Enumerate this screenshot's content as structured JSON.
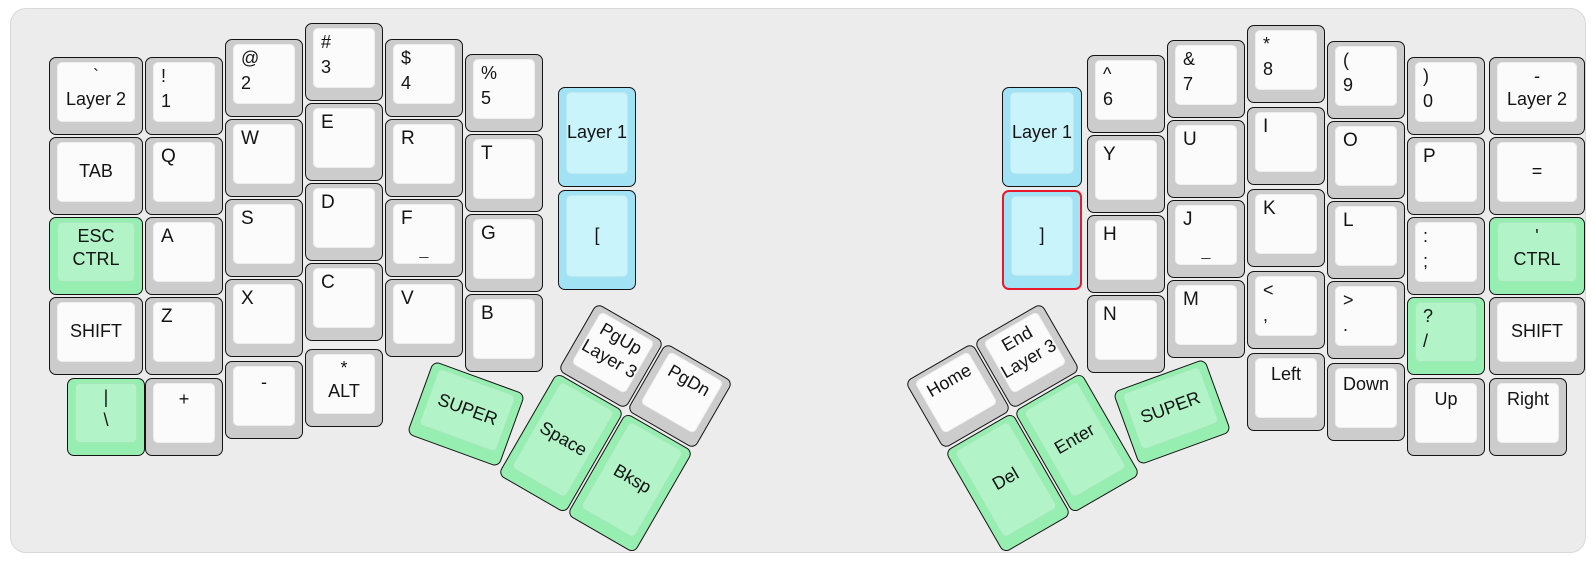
{
  "app": {
    "title": "Split ergonomic keyboard layout"
  },
  "colors": {
    "page_bg": "#ffffff",
    "board_bg": "#ececec",
    "board_border": "#d9d9d9",
    "key_border": "#141414",
    "white_bezel": "#cccccc",
    "white_top": "#fbfbfb",
    "green_bezel": "#96eeb0",
    "green_top": "#b2f4c7",
    "blue_bezel": "#a2e2f5",
    "blue_top": "#c9f4fc",
    "highlight_border": "#e8192c",
    "text": "#141414"
  },
  "keys": [
    {
      "id": "key-layer2-left",
      "x": 38,
      "y": 48,
      "w": 94,
      "h": 78,
      "rot": 0,
      "color": "white",
      "style": "center2",
      "labels": [
        "`",
        "Layer 2"
      ]
    },
    {
      "id": "key-tab",
      "x": 38,
      "y": 128,
      "w": 94,
      "h": 78,
      "rot": 0,
      "color": "white",
      "style": "center",
      "labels": [
        "TAB"
      ]
    },
    {
      "id": "key-esc-ctrl",
      "x": 38,
      "y": 208,
      "w": 94,
      "h": 78,
      "rot": 0,
      "color": "green",
      "style": "center2",
      "labels": [
        "ESC",
        "CTRL"
      ]
    },
    {
      "id": "key-shift-left",
      "x": 38,
      "y": 288,
      "w": 94,
      "h": 78,
      "rot": 0,
      "color": "white",
      "style": "center",
      "labels": [
        "SHIFT"
      ]
    },
    {
      "id": "key-pipe-backslash",
      "x": 56,
      "y": 369,
      "w": 78,
      "h": 78,
      "rot": 0,
      "color": "green",
      "style": "center2",
      "labels": [
        "|",
        "\\"
      ]
    },
    {
      "id": "key-1",
      "x": 134,
      "y": 48,
      "w": 78,
      "h": 78,
      "rot": 0,
      "color": "white",
      "style": "pair",
      "labels": [
        "!",
        "1"
      ]
    },
    {
      "id": "key-q",
      "x": 134,
      "y": 128,
      "w": 78,
      "h": 78,
      "rot": 0,
      "color": "white",
      "style": "tl",
      "labels": [
        "Q"
      ]
    },
    {
      "id": "key-a",
      "x": 134,
      "y": 208,
      "w": 78,
      "h": 78,
      "rot": 0,
      "color": "white",
      "style": "tl",
      "labels": [
        "A"
      ]
    },
    {
      "id": "key-z",
      "x": 134,
      "y": 288,
      "w": 78,
      "h": 78,
      "rot": 0,
      "color": "white",
      "style": "tl",
      "labels": [
        "Z"
      ]
    },
    {
      "id": "key-plus",
      "x": 134,
      "y": 369,
      "w": 78,
      "h": 78,
      "rot": 0,
      "color": "white",
      "style": "top",
      "labels": [
        "+"
      ]
    },
    {
      "id": "key-2",
      "x": 214,
      "y": 30,
      "w": 78,
      "h": 78,
      "rot": 0,
      "color": "white",
      "style": "pair",
      "labels": [
        "@",
        "2"
      ]
    },
    {
      "id": "key-w",
      "x": 214,
      "y": 110,
      "w": 78,
      "h": 78,
      "rot": 0,
      "color": "white",
      "style": "tl",
      "labels": [
        "W"
      ]
    },
    {
      "id": "key-s",
      "x": 214,
      "y": 190,
      "w": 78,
      "h": 78,
      "rot": 0,
      "color": "white",
      "style": "tl",
      "labels": [
        "S"
      ]
    },
    {
      "id": "key-x",
      "x": 214,
      "y": 270,
      "w": 78,
      "h": 78,
      "rot": 0,
      "color": "white",
      "style": "tl",
      "labels": [
        "X"
      ]
    },
    {
      "id": "key-minus-left",
      "x": 214,
      "y": 352,
      "w": 78,
      "h": 78,
      "rot": 0,
      "color": "white",
      "style": "top",
      "labels": [
        "-"
      ]
    },
    {
      "id": "key-3",
      "x": 294,
      "y": 14,
      "w": 78,
      "h": 78,
      "rot": 0,
      "color": "white",
      "style": "pair",
      "labels": [
        "#",
        "3"
      ]
    },
    {
      "id": "key-e",
      "x": 294,
      "y": 94,
      "w": 78,
      "h": 78,
      "rot": 0,
      "color": "white",
      "style": "tl",
      "labels": [
        "E"
      ]
    },
    {
      "id": "key-d",
      "x": 294,
      "y": 174,
      "w": 78,
      "h": 78,
      "rot": 0,
      "color": "white",
      "style": "tl",
      "labels": [
        "D"
      ]
    },
    {
      "id": "key-c",
      "x": 294,
      "y": 254,
      "w": 78,
      "h": 78,
      "rot": 0,
      "color": "white",
      "style": "tl",
      "labels": [
        "C"
      ]
    },
    {
      "id": "key-star-alt",
      "x": 294,
      "y": 340,
      "w": 78,
      "h": 78,
      "rot": 0,
      "color": "white",
      "style": "center2",
      "labels": [
        "*",
        "ALT"
      ]
    },
    {
      "id": "key-4",
      "x": 374,
      "y": 30,
      "w": 78,
      "h": 78,
      "rot": 0,
      "color": "white",
      "style": "pair",
      "labels": [
        "$",
        "4"
      ]
    },
    {
      "id": "key-r",
      "x": 374,
      "y": 110,
      "w": 78,
      "h": 78,
      "rot": 0,
      "color": "white",
      "style": "tl",
      "labels": [
        "R"
      ]
    },
    {
      "id": "key-f",
      "x": 374,
      "y": 190,
      "w": 78,
      "h": 78,
      "rot": 0,
      "color": "white",
      "style": "homing",
      "labels": [
        "F",
        "_"
      ]
    },
    {
      "id": "key-v",
      "x": 374,
      "y": 270,
      "w": 78,
      "h": 78,
      "rot": 0,
      "color": "white",
      "style": "tl",
      "labels": [
        "V"
      ]
    },
    {
      "id": "key-5",
      "x": 454,
      "y": 45,
      "w": 78,
      "h": 78,
      "rot": 0,
      "color": "white",
      "style": "pair",
      "labels": [
        "%",
        "5"
      ]
    },
    {
      "id": "key-t",
      "x": 454,
      "y": 125,
      "w": 78,
      "h": 78,
      "rot": 0,
      "color": "white",
      "style": "tl",
      "labels": [
        "T"
      ]
    },
    {
      "id": "key-g",
      "x": 454,
      "y": 205,
      "w": 78,
      "h": 78,
      "rot": 0,
      "color": "white",
      "style": "tl",
      "labels": [
        "G"
      ]
    },
    {
      "id": "key-b",
      "x": 454,
      "y": 285,
      "w": 78,
      "h": 78,
      "rot": 0,
      "color": "white",
      "style": "tl",
      "labels": [
        "B"
      ]
    },
    {
      "id": "key-layer1-left",
      "x": 547,
      "y": 78,
      "w": 78,
      "h": 100,
      "rot": 0,
      "color": "blue",
      "style": "center",
      "labels": [
        "Layer 1"
      ]
    },
    {
      "id": "key-lbracket",
      "x": 547,
      "y": 181,
      "w": 78,
      "h": 100,
      "rot": 0,
      "color": "blue",
      "style": "center",
      "labels": [
        "["
      ]
    },
    {
      "id": "key-pgup-layer3",
      "x": 561,
      "y": 308,
      "w": 78,
      "h": 78,
      "rot": 30,
      "color": "white",
      "style": "center2",
      "labels": [
        "PgUp",
        "Layer 3"
      ]
    },
    {
      "id": "key-pgdn",
      "x": 630,
      "y": 348,
      "w": 78,
      "h": 78,
      "rot": 30,
      "color": "white",
      "style": "top",
      "labels": [
        "PgDn"
      ]
    },
    {
      "id": "key-super-left",
      "x": 406,
      "y": 366,
      "w": 98,
      "h": 78,
      "rot": 20,
      "color": "green",
      "style": "center",
      "labels": [
        "SUPER"
      ]
    },
    {
      "id": "key-space",
      "x": 511,
      "y": 375,
      "w": 78,
      "h": 118,
      "rot": 30,
      "color": "green",
      "style": "center",
      "labels": [
        "Space"
      ]
    },
    {
      "id": "key-bksp",
      "x": 580,
      "y": 415,
      "w": 78,
      "h": 118,
      "rot": 30,
      "color": "green",
      "style": "center",
      "labels": [
        "Bksp"
      ]
    },
    {
      "id": "key-layer1-right",
      "x": 991,
      "y": 78,
      "w": 80,
      "h": 100,
      "rot": 0,
      "color": "blue",
      "style": "center",
      "labels": [
        "Layer 1"
      ]
    },
    {
      "id": "key-rbracket",
      "x": 991,
      "y": 181,
      "w": 80,
      "h": 100,
      "rot": 0,
      "color": "blue",
      "style": "center",
      "labels": [
        "]"
      ],
      "highlight": true
    },
    {
      "id": "key-6",
      "x": 1076,
      "y": 46,
      "w": 78,
      "h": 78,
      "rot": 0,
      "color": "white",
      "style": "pair",
      "labels": [
        "^",
        "6"
      ]
    },
    {
      "id": "key-y",
      "x": 1076,
      "y": 126,
      "w": 78,
      "h": 78,
      "rot": 0,
      "color": "white",
      "style": "tl",
      "labels": [
        "Y"
      ]
    },
    {
      "id": "key-h",
      "x": 1076,
      "y": 206,
      "w": 78,
      "h": 78,
      "rot": 0,
      "color": "white",
      "style": "tl",
      "labels": [
        "H"
      ]
    },
    {
      "id": "key-n",
      "x": 1076,
      "y": 286,
      "w": 78,
      "h": 78,
      "rot": 0,
      "color": "white",
      "style": "tl",
      "labels": [
        "N"
      ]
    },
    {
      "id": "key-7",
      "x": 1156,
      "y": 31,
      "w": 78,
      "h": 78,
      "rot": 0,
      "color": "white",
      "style": "pair",
      "labels": [
        "&",
        "7"
      ]
    },
    {
      "id": "key-u",
      "x": 1156,
      "y": 111,
      "w": 78,
      "h": 78,
      "rot": 0,
      "color": "white",
      "style": "tl",
      "labels": [
        "U"
      ]
    },
    {
      "id": "key-j",
      "x": 1156,
      "y": 191,
      "w": 78,
      "h": 78,
      "rot": 0,
      "color": "white",
      "style": "homing",
      "labels": [
        "J",
        "_"
      ]
    },
    {
      "id": "key-m",
      "x": 1156,
      "y": 271,
      "w": 78,
      "h": 78,
      "rot": 0,
      "color": "white",
      "style": "tl",
      "labels": [
        "M"
      ]
    },
    {
      "id": "key-8",
      "x": 1236,
      "y": 16,
      "w": 78,
      "h": 78,
      "rot": 0,
      "color": "white",
      "style": "pair",
      "labels": [
        "*",
        "8"
      ]
    },
    {
      "id": "key-i",
      "x": 1236,
      "y": 98,
      "w": 78,
      "h": 78,
      "rot": 0,
      "color": "white",
      "style": "tl",
      "labels": [
        "I"
      ]
    },
    {
      "id": "key-k",
      "x": 1236,
      "y": 180,
      "w": 78,
      "h": 78,
      "rot": 0,
      "color": "white",
      "style": "tl",
      "labels": [
        "K"
      ]
    },
    {
      "id": "key-comma",
      "x": 1236,
      "y": 262,
      "w": 78,
      "h": 78,
      "rot": 0,
      "color": "white",
      "style": "pair",
      "labels": [
        "<",
        ","
      ]
    },
    {
      "id": "key-left",
      "x": 1236,
      "y": 344,
      "w": 78,
      "h": 78,
      "rot": 0,
      "color": "white",
      "style": "top",
      "labels": [
        "Left"
      ]
    },
    {
      "id": "key-9",
      "x": 1316,
      "y": 32,
      "w": 78,
      "h": 78,
      "rot": 0,
      "color": "white",
      "style": "pair",
      "labels": [
        "(",
        "9"
      ]
    },
    {
      "id": "key-o",
      "x": 1316,
      "y": 112,
      "w": 78,
      "h": 78,
      "rot": 0,
      "color": "white",
      "style": "tl",
      "labels": [
        "O"
      ]
    },
    {
      "id": "key-l",
      "x": 1316,
      "y": 192,
      "w": 78,
      "h": 78,
      "rot": 0,
      "color": "white",
      "style": "tl",
      "labels": [
        "L"
      ]
    },
    {
      "id": "key-period",
      "x": 1316,
      "y": 272,
      "w": 78,
      "h": 78,
      "rot": 0,
      "color": "white",
      "style": "pair",
      "labels": [
        ">",
        "."
      ]
    },
    {
      "id": "key-down",
      "x": 1316,
      "y": 354,
      "w": 78,
      "h": 78,
      "rot": 0,
      "color": "white",
      "style": "top",
      "labels": [
        "Down"
      ]
    },
    {
      "id": "key-0",
      "x": 1396,
      "y": 48,
      "w": 78,
      "h": 78,
      "rot": 0,
      "color": "white",
      "style": "pair",
      "labels": [
        ")",
        "0"
      ]
    },
    {
      "id": "key-p",
      "x": 1396,
      "y": 128,
      "w": 78,
      "h": 78,
      "rot": 0,
      "color": "white",
      "style": "tl",
      "labels": [
        "P"
      ]
    },
    {
      "id": "key-semicolon",
      "x": 1396,
      "y": 208,
      "w": 78,
      "h": 78,
      "rot": 0,
      "color": "white",
      "style": "pair",
      "labels": [
        ":",
        ";"
      ]
    },
    {
      "id": "key-slash",
      "x": 1396,
      "y": 288,
      "w": 78,
      "h": 78,
      "rot": 0,
      "color": "green",
      "style": "pair",
      "labels": [
        "?",
        "/"
      ]
    },
    {
      "id": "key-up",
      "x": 1396,
      "y": 369,
      "w": 78,
      "h": 78,
      "rot": 0,
      "color": "white",
      "style": "top",
      "labels": [
        "Up"
      ]
    },
    {
      "id": "key-layer2-right",
      "x": 1478,
      "y": 48,
      "w": 96,
      "h": 78,
      "rot": 0,
      "color": "white",
      "style": "center2",
      "labels": [
        "-",
        "Layer 2"
      ]
    },
    {
      "id": "key-equals",
      "x": 1478,
      "y": 128,
      "w": 96,
      "h": 78,
      "rot": 0,
      "color": "white",
      "style": "center",
      "labels": [
        "="
      ]
    },
    {
      "id": "key-quote-ctrl",
      "x": 1478,
      "y": 208,
      "w": 96,
      "h": 78,
      "rot": 0,
      "color": "green",
      "style": "center2",
      "labels": [
        "'",
        "CTRL"
      ]
    },
    {
      "id": "key-shift-right",
      "x": 1478,
      "y": 288,
      "w": 96,
      "h": 78,
      "rot": 0,
      "color": "white",
      "style": "center",
      "labels": [
        "SHIFT"
      ]
    },
    {
      "id": "key-right",
      "x": 1478,
      "y": 369,
      "w": 78,
      "h": 78,
      "rot": 0,
      "color": "white",
      "style": "top",
      "labels": [
        "Right"
      ]
    },
    {
      "id": "key-home",
      "x": 908,
      "y": 348,
      "w": 78,
      "h": 78,
      "rot": -30,
      "color": "white",
      "style": "top",
      "labels": [
        "Home"
      ]
    },
    {
      "id": "key-end-layer3",
      "x": 977,
      "y": 308,
      "w": 78,
      "h": 78,
      "rot": -30,
      "color": "white",
      "style": "center2",
      "labels": [
        "End",
        "Layer 3"
      ]
    },
    {
      "id": "key-del",
      "x": 958,
      "y": 415,
      "w": 78,
      "h": 118,
      "rot": -30,
      "color": "green",
      "style": "center",
      "labels": [
        "Del"
      ]
    },
    {
      "id": "key-enter",
      "x": 1027,
      "y": 375,
      "w": 78,
      "h": 118,
      "rot": -30,
      "color": "green",
      "style": "center",
      "labels": [
        "Enter"
      ]
    },
    {
      "id": "key-super-right",
      "x": 1112,
      "y": 364,
      "w": 98,
      "h": 78,
      "rot": -20,
      "color": "green",
      "style": "center",
      "labels": [
        "SUPER"
      ]
    }
  ]
}
